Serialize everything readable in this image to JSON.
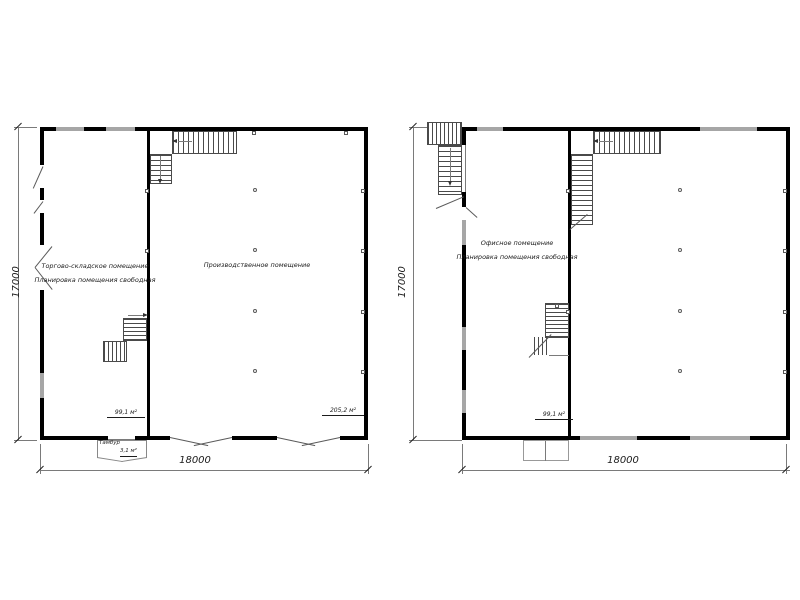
{
  "colors": {
    "wall": "#000000",
    "window": "#a6a6a6",
    "thin_line": "#7a7a7a",
    "text": "#1c1c1c"
  },
  "plans": [
    {
      "id": "first-floor-plan",
      "dim_width": "18000",
      "dim_height": "17000",
      "rooms": [
        {
          "label_line1": "Торгово-складское помещение",
          "label_line2": "Планировка помещения свободная",
          "area": "99,1 м²"
        },
        {
          "label_line1": "Производственное помещение",
          "area": "205,2 м²"
        },
        {
          "label_line1": "Тамбур",
          "area": "3,1 м²"
        }
      ]
    },
    {
      "id": "second-floor-plan",
      "dim_width": "18000",
      "dim_height": "17000",
      "rooms": [
        {
          "label_line1": "Офисное помещение",
          "label_line2": "Планировка помещения свободная",
          "area": "99,1 м²"
        }
      ]
    }
  ]
}
